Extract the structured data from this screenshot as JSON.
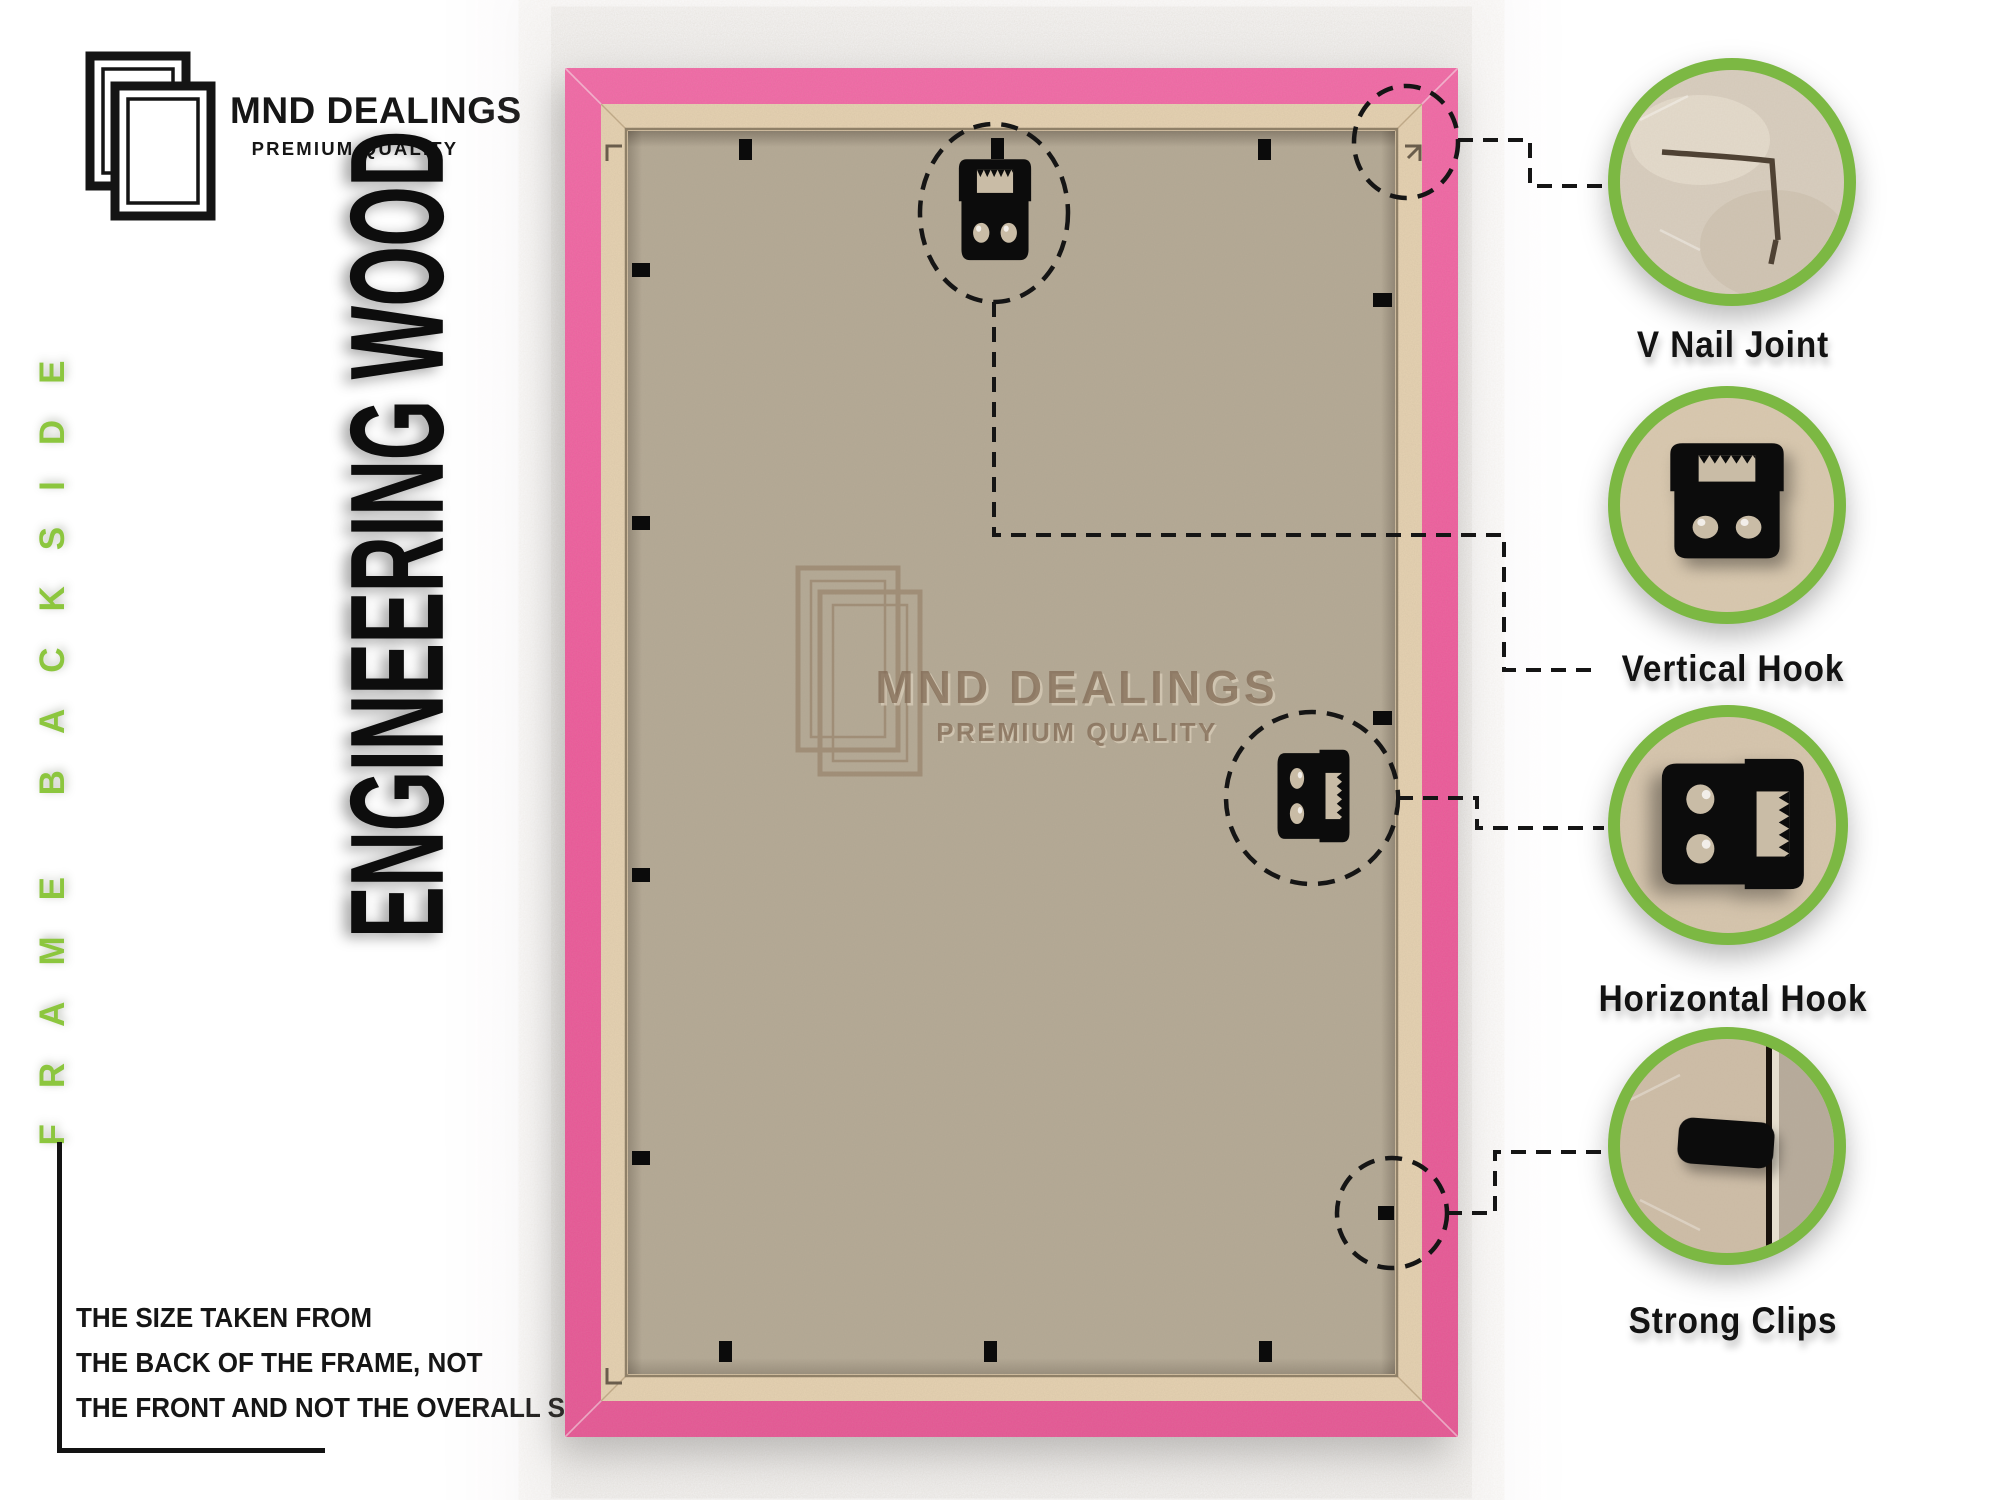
{
  "brand": {
    "name": "MND DEALINGS",
    "tagline": "PREMIUM QUALITY"
  },
  "side_label": "FRAME BACKSIDE",
  "material_label": "ENGINEERING WOOD",
  "watermark": {
    "name": "MND DEALINGS",
    "tagline": "PREMIUM QUALITY"
  },
  "size_note": {
    "lines": [
      "THE SIZE TAKEN FROM",
      "THE BACK OF THE FRAME, NOT",
      "THE FRONT AND NOT THE OVERALL SIZE."
    ]
  },
  "callouts": [
    {
      "id": "v-nail-joint",
      "label": "V Nail Joint"
    },
    {
      "id": "vertical-hook",
      "label": "Vertical Hook"
    },
    {
      "id": "horizontal-hook",
      "label": "Horizontal Hook"
    },
    {
      "id": "strong-clips",
      "label": "Strong Clips"
    }
  ],
  "colors": {
    "accent_green": "#8cc63e",
    "ring_green": "#7cb843",
    "frame_pink": "#f0549c",
    "wood_strip": "#e8d4b4",
    "backing": "#b5aa96",
    "text_black": "#141414"
  }
}
